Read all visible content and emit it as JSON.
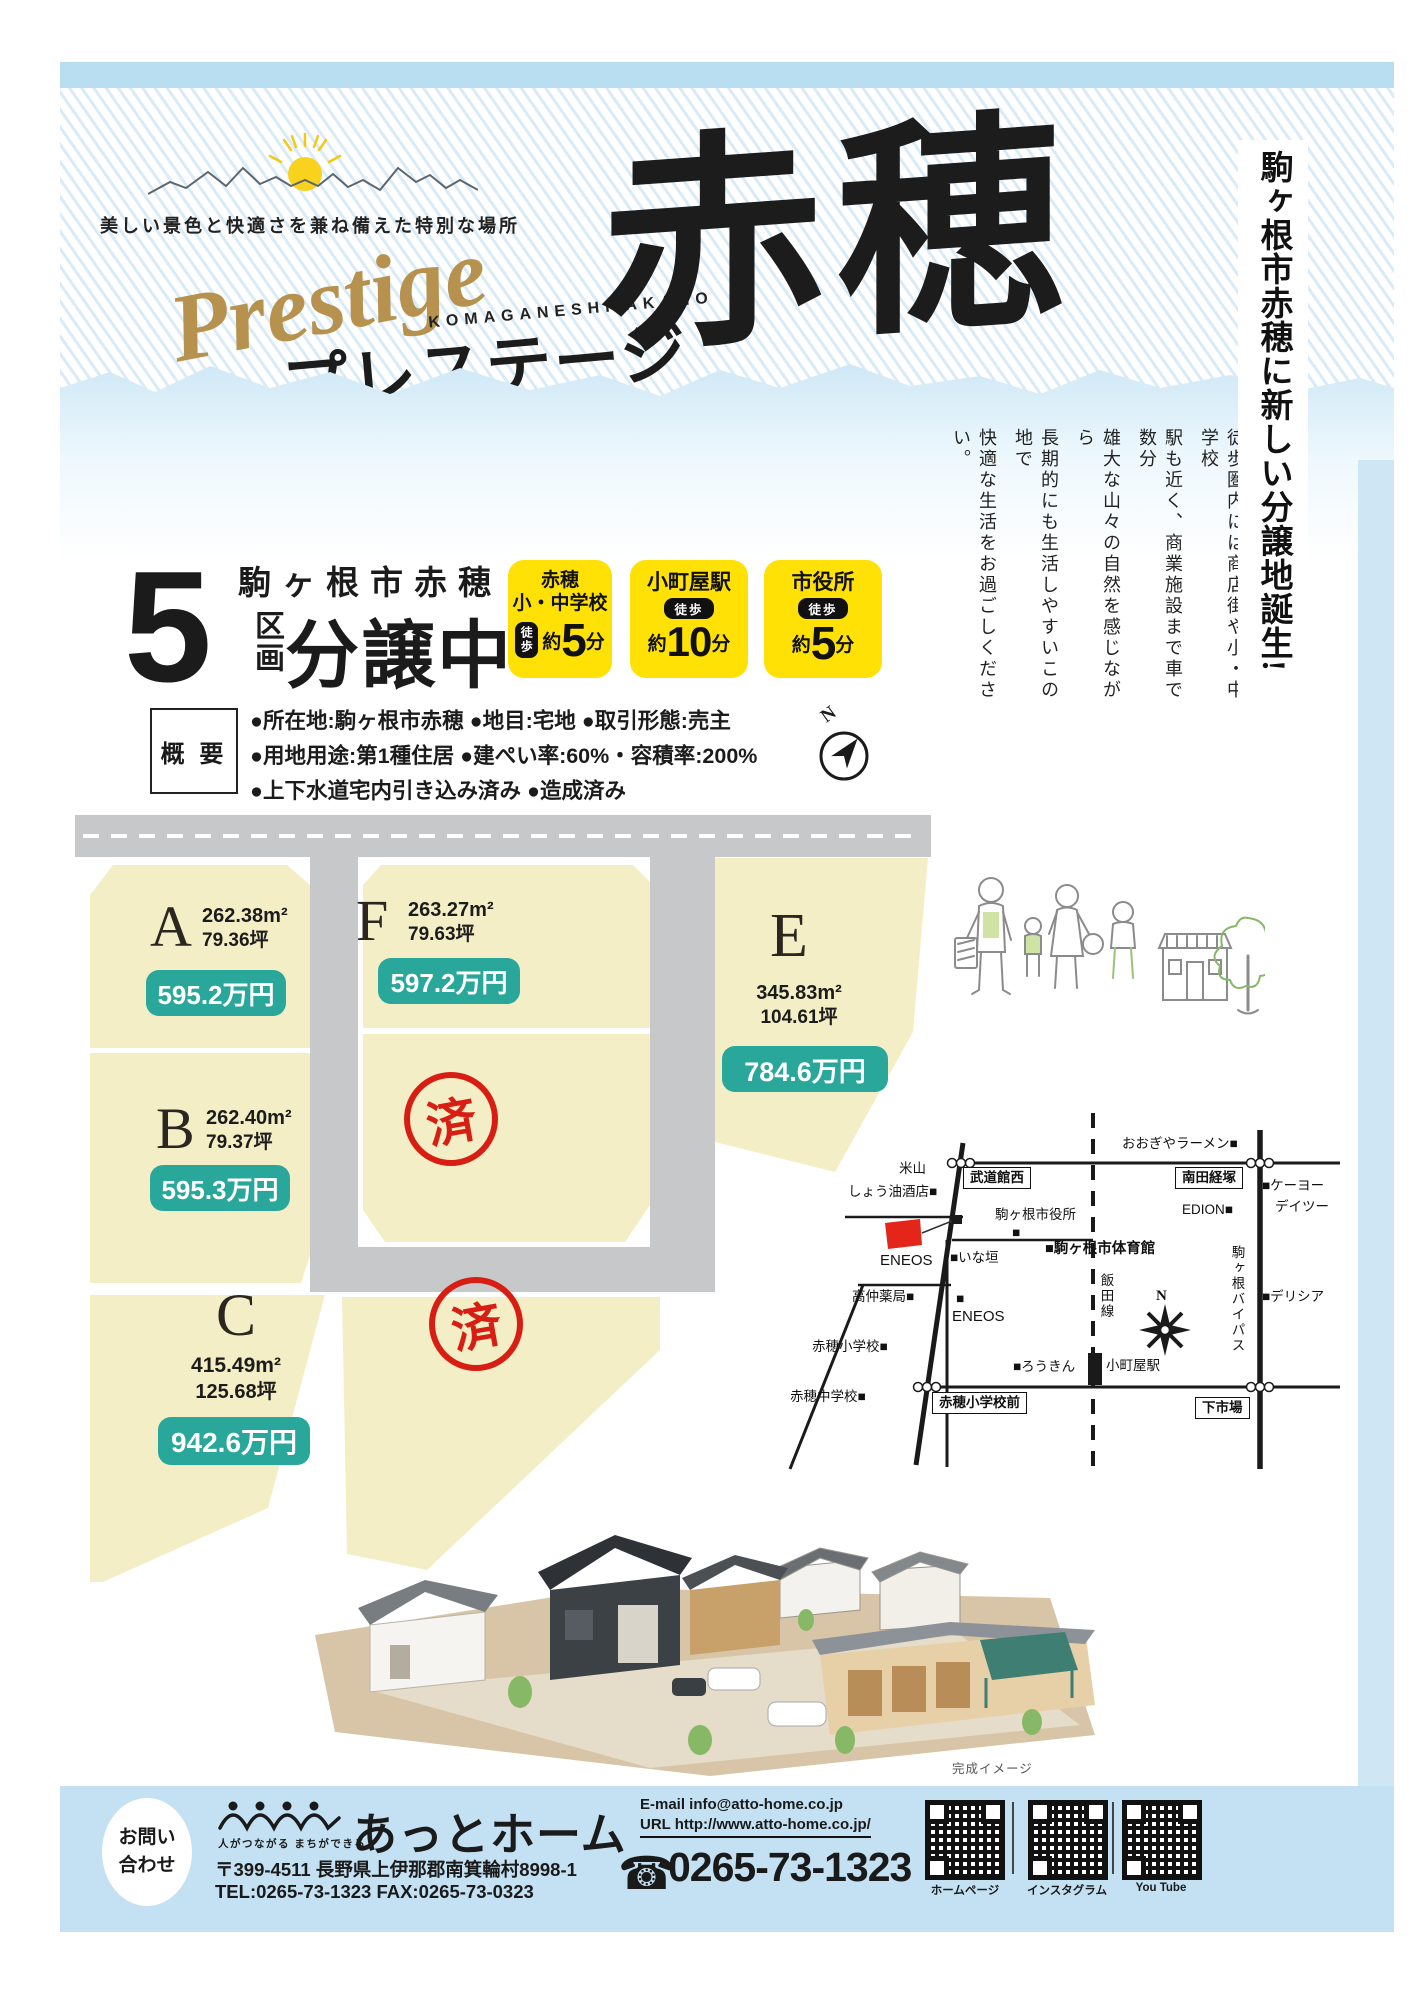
{
  "hero": {
    "tagline": "美しい景色と快適さを兼ね備えた特別な場所",
    "script": "Prestige",
    "romaji": "KOMAGANESHI AKAHO",
    "katakana": "プレステージ",
    "kanji": "赤穂"
  },
  "side_headline": "駒ヶ根市赤穂に新しい分譲地誕生!",
  "intro_columns": [
    "窓の向こうには美しい中央アルプス",
    "徒歩圏内には商店街や小・中学校",
    "駅も近く、商業施設まで車で数分",
    "雄大な山々の自然を感じながら",
    "長期的にも生活しやすいこの地で",
    "快適な生活をお過ごしください。"
  ],
  "sale": {
    "count": "5",
    "location": "駒ヶ根市赤穂",
    "unit": "区画",
    "status": "分譲中"
  },
  "access_badges": [
    {
      "line1": "赤穂",
      "line2": "小・中学校",
      "walk": "徒歩",
      "approx": "約",
      "minutes": "5",
      "min_unit": "分"
    },
    {
      "line1": "小町屋駅",
      "walk": "徒歩",
      "approx": "約",
      "minutes": "10",
      "min_unit": "分"
    },
    {
      "line1": "市役所",
      "walk": "徒歩",
      "approx": "約",
      "minutes": "5",
      "min_unit": "分"
    }
  ],
  "overview": {
    "title": "概 要",
    "lines": [
      "●所在地:駒ヶ根市赤穂 ●地目:宅地 ●取引形態:売主",
      "●用地用途:第1種住居 ●建ぺい率:60%・容積率:200%",
      "●上下水道宅内引き込み済み ●造成済み"
    ]
  },
  "compass_n": "N",
  "lots": {
    "a": {
      "letter": "A",
      "area": "262.38m²",
      "tsubo": "79.36坪",
      "price": "595.2万円"
    },
    "b": {
      "letter": "B",
      "area": "262.40m²",
      "tsubo": "79.37坪",
      "price": "595.3万円"
    },
    "c": {
      "letter": "C",
      "area": "415.49m²",
      "tsubo": "125.68坪",
      "price": "942.6万円"
    },
    "e": {
      "letter": "E",
      "area": "345.83m²",
      "tsubo": "104.61坪",
      "price": "784.6万円"
    },
    "f": {
      "letter": "F",
      "area": "263.27m²",
      "tsubo": "79.63坪",
      "price": "597.2万円"
    },
    "sold": "済"
  },
  "map": {
    "labels": [
      {
        "text": "米山"
      },
      {
        "text": "しょう油酒店■"
      },
      {
        "text": "武道館西"
      },
      {
        "text": "おおぎやラーメン■"
      },
      {
        "text": "南田経塚"
      },
      {
        "text": "■ケーヨー"
      },
      {
        "text": "デイツー"
      },
      {
        "text": "EDION■"
      },
      {
        "text": "駒ヶ根市役所"
      },
      {
        "text": "■"
      },
      {
        "text": "■いな垣"
      },
      {
        "text": "■駒ヶ根市体育館"
      },
      {
        "text": "ENEOS"
      },
      {
        "text": "高仲薬局■"
      },
      {
        "text": "■"
      },
      {
        "text": "ENEOS"
      },
      {
        "text": "赤穂小学校■"
      },
      {
        "text": "飯田線"
      },
      {
        "text": "駒ヶ根バイパス"
      },
      {
        "text": "■デリシア"
      },
      {
        "text": "■ろうきん"
      },
      {
        "text": "小町屋駅"
      },
      {
        "text": "赤穂中学校■"
      },
      {
        "text": "赤穂小学校前"
      },
      {
        "text": "下市場"
      },
      {
        "text": "N"
      }
    ]
  },
  "render_caption": "完成イメージ",
  "footer": {
    "inquiry_l1": "お問い",
    "inquiry_l2": "合わせ",
    "logo_tagline": "人がつながる まちができる",
    "company": "あっとホーム",
    "postal_address": "〒399-4511 長野県上伊那郡南箕輪村8998-1",
    "tel_fax": "TEL:0265-73-1323  FAX:0265-73-0323",
    "email": "E-mail info@atto-home.co.jp",
    "url": "URL http://www.atto-home.co.jp/",
    "phone_icon": "☎",
    "phone": "0265-73-1323",
    "qr_labels": [
      "ホームページ",
      "インスタグラム",
      "You Tube"
    ]
  },
  "colors": {
    "accent_teal": "#2aa79b",
    "badge_yellow": "#ffe105",
    "stamp_red": "#d81e13",
    "lot_cream": "#f3eec5",
    "road_gray": "#c7c8ca",
    "light_blue": "#cfe7f5",
    "gold": "#b6924e"
  }
}
